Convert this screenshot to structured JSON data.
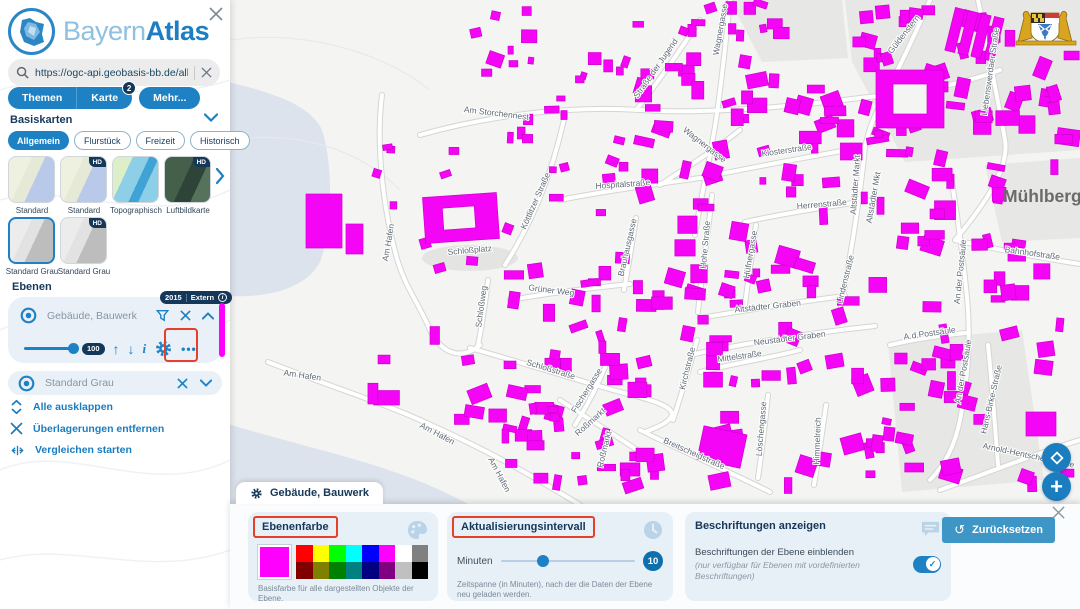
{
  "app": {
    "brand_light": "Bayern",
    "brand_bold": "Atlas"
  },
  "sidebar": {
    "search": {
      "value": "https://ogc-api.geobasis-bb.de/alkis-verein"
    },
    "nav": [
      {
        "label": "Themen"
      },
      {
        "label": "Karte",
        "badge": "2"
      },
      {
        "label": "Mehr..."
      }
    ],
    "basiskarten": {
      "title": "Basiskarten",
      "tabs": [
        {
          "label": "Allgemein"
        },
        {
          "label": "Flurstück"
        },
        {
          "label": "Freizeit"
        },
        {
          "label": "Historisch"
        }
      ],
      "thumbs": [
        {
          "label": "Standard"
        },
        {
          "label": "Standard",
          "hd": "HD"
        },
        {
          "label": "Topographisch"
        },
        {
          "label": "Luftbildkarte",
          "hd": "HD"
        },
        {
          "label": "Standard Grau"
        },
        {
          "label": "Standard Grau",
          "hd": "HD"
        }
      ]
    },
    "ebenen": {
      "title": "Ebenen",
      "layer1": {
        "name": "Gebäude, Bauwerk",
        "badge_year": "2015",
        "badge_source": "Extern",
        "opacity": "100"
      },
      "layer2": {
        "name": "Standard Grau"
      },
      "actions": [
        {
          "label": "Alle ausklappen"
        },
        {
          "label": "Überlagerungen entfernen"
        },
        {
          "label": "Vergleichen starten"
        }
      ]
    }
  },
  "map": {
    "city_label": "Mühlberg",
    "street_labels": [
      {
        "t": "Am Storchennest",
        "x": 496,
        "y": 116,
        "r": 7
      },
      {
        "t": "Straße der Jugend",
        "x": 658,
        "y": 70,
        "r": -55
      },
      {
        "t": "Wagnergasse",
        "x": 703,
        "y": 147,
        "r": 38
      },
      {
        "t": "Wagnergasse",
        "x": 723,
        "y": 30,
        "r": -80
      },
      {
        "t": "Güldenstern",
        "x": 906,
        "y": 36,
        "r": -52
      },
      {
        "t": "Liebenswerdaer Straße",
        "x": 993,
        "y": 72,
        "r": -82
      },
      {
        "t": "Köttlitzer Straße",
        "x": 538,
        "y": 202,
        "r": -66
      },
      {
        "t": "Hospitalstraße",
        "x": 623,
        "y": 187,
        "r": -4
      },
      {
        "t": "Klosterstraße",
        "x": 787,
        "y": 153,
        "r": -8
      },
      {
        "t": "Herrenstraße",
        "x": 822,
        "y": 207,
        "r": -5
      },
      {
        "t": "Altstädter Markt",
        "x": 858,
        "y": 185,
        "r": -86
      },
      {
        "t": "Altstädter Mkt",
        "x": 876,
        "y": 198,
        "r": -80
      },
      {
        "t": "Hohe Straße",
        "x": 708,
        "y": 245,
        "r": -85
      },
      {
        "t": "Hüfnergasse",
        "x": 753,
        "y": 255,
        "r": -80
      },
      {
        "t": "Lindenstraße",
        "x": 848,
        "y": 280,
        "r": -76
      },
      {
        "t": "Brauhausgasse",
        "x": 630,
        "y": 248,
        "r": -77
      },
      {
        "t": "Schloßplatz",
        "x": 470,
        "y": 253,
        "r": -5
      },
      {
        "t": "Am Hafen",
        "x": 391,
        "y": 243,
        "r": -80
      },
      {
        "t": "Am Hafen",
        "x": 302,
        "y": 378,
        "r": 8
      },
      {
        "t": "Am Hafen",
        "x": 436,
        "y": 436,
        "r": 28
      },
      {
        "t": "Am Hafen",
        "x": 497,
        "y": 476,
        "r": 62
      },
      {
        "t": "Altstädter Graben",
        "x": 768,
        "y": 309,
        "r": -6
      },
      {
        "t": "Neustädter Graben",
        "x": 790,
        "y": 341,
        "r": -7
      },
      {
        "t": "Mittelstraße",
        "x": 740,
        "y": 359,
        "r": -8
      },
      {
        "t": "Kirchstraße",
        "x": 690,
        "y": 369,
        "r": -76
      },
      {
        "t": "Löschengasse",
        "x": 764,
        "y": 429,
        "r": -85
      },
      {
        "t": "Himmelreich",
        "x": 820,
        "y": 441,
        "r": -88
      },
      {
        "t": "Breitscheidstraße",
        "x": 693,
        "y": 456,
        "r": 24
      },
      {
        "t": "Roßmarkt",
        "x": 592,
        "y": 424,
        "r": -42
      },
      {
        "t": "Roßmarkt",
        "x": 607,
        "y": 450,
        "r": -76
      },
      {
        "t": "Fischergasse",
        "x": 589,
        "y": 392,
        "r": -58
      },
      {
        "t": "Schloßstraße",
        "x": 550,
        "y": 372,
        "r": 17
      },
      {
        "t": "Schloßweg",
        "x": 484,
        "y": 307,
        "r": -82
      },
      {
        "t": "Grüner Weg",
        "x": 551,
        "y": 293,
        "r": 7
      },
      {
        "t": "Bahnhofstraße",
        "x": 1032,
        "y": 256,
        "r": 8
      },
      {
        "t": "An der Postsäule",
        "x": 963,
        "y": 272,
        "r": -84
      },
      {
        "t": "A.d.Postsäule",
        "x": 930,
        "y": 336,
        "r": -8
      },
      {
        "t": "An der Postsäule",
        "x": 966,
        "y": 372,
        "r": -80
      },
      {
        "t": "Hans-Birke-Straße",
        "x": 994,
        "y": 400,
        "r": -77
      },
      {
        "t": "Arnold-Hentschel-Straße",
        "x": 1028,
        "y": 458,
        "r": 12
      }
    ]
  },
  "panel": {
    "tab_title": "Gebäude, Bauwerk",
    "ebenenfarbe": {
      "title": "Ebenenfarbe",
      "caption": "Basisfarbe für alle dargestellten Objekte der Ebene.",
      "selected": "#ff00ff",
      "palette": [
        "#ff0000",
        "#ffff00",
        "#00ff00",
        "#00ffff",
        "#0000ff",
        "#ff00ff",
        "#ffffff",
        "#808080",
        "#800000",
        "#808000",
        "#008000",
        "#008080",
        "#000080",
        "#800080",
        "#c0c0c0",
        "#000000"
      ]
    },
    "interval": {
      "title": "Aktualisierungsintervall",
      "unit": "Minuten",
      "value": "10",
      "caption": "Zeitspanne (in Minuten), nach der die Daten der Ebene neu geladen werden."
    },
    "labels": {
      "title": "Beschriftungen anzeigen",
      "text": "Beschriftungen der Ebene einblenden",
      "note": "(nur verfügbar für Ebenen mit vordefinierten Beschriftungen)"
    },
    "reset": "Zurücksetzen"
  },
  "colors": {
    "accent": "#1d81c4",
    "dark": "#14375a",
    "magenta": "#ff00ff",
    "annotation": "#e6402a",
    "link": "#1a7dc0"
  }
}
